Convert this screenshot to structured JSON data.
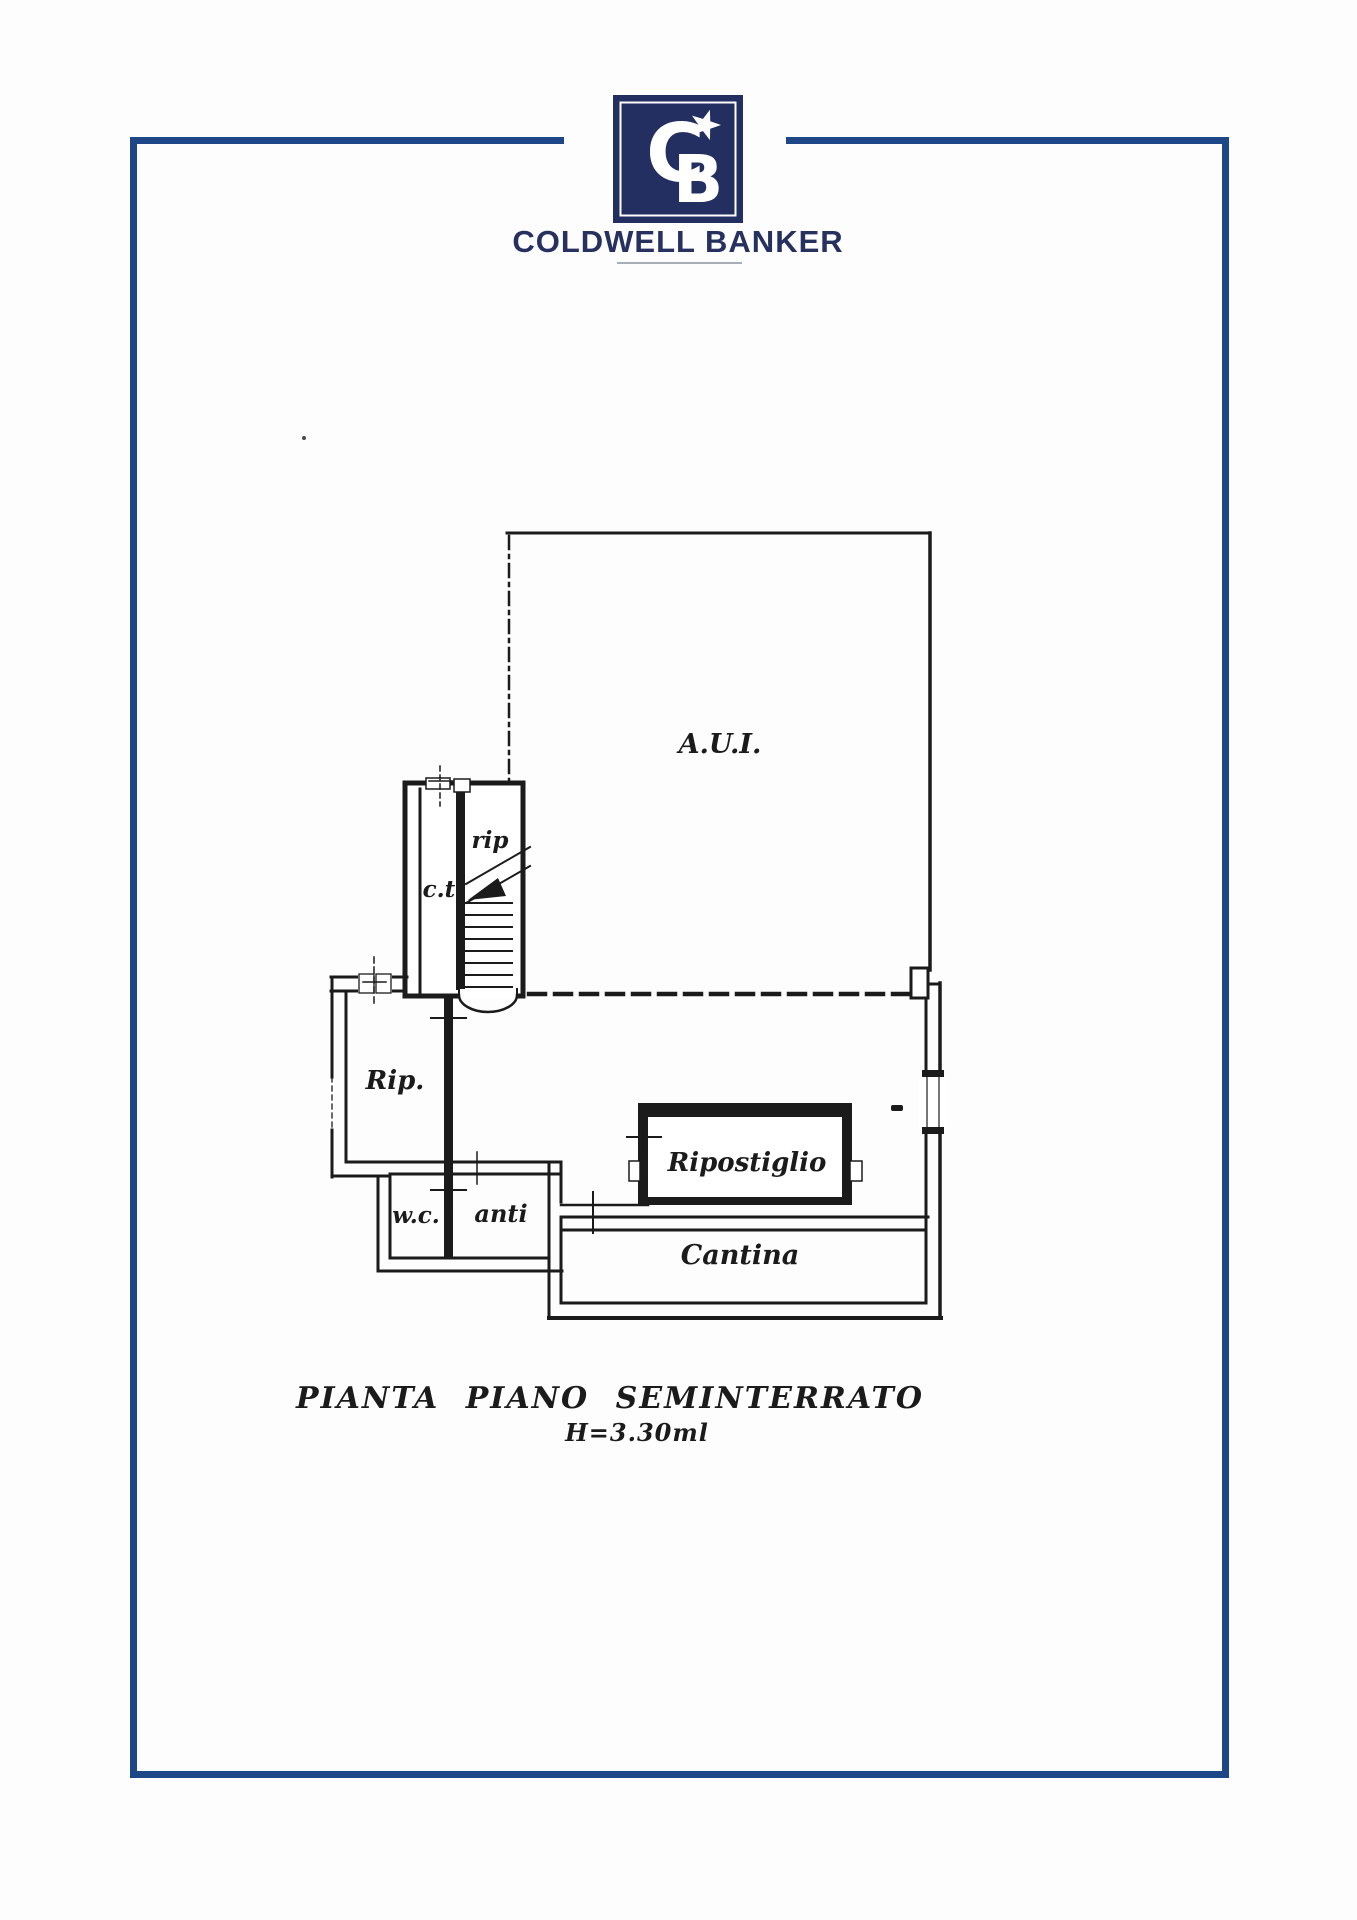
{
  "brand": {
    "wordmark": "COLDWELL BANKER",
    "monogram": {
      "letter_c": "C",
      "letter_b": "B"
    },
    "colors": {
      "logo_navy": "#232f60",
      "wordmark_navy": "#27315f",
      "frame_navy": "#1d4787",
      "underline_gray": "#a8aeb6"
    }
  },
  "floor_plan": {
    "ink": "#1b1b1b",
    "rooms": [
      {
        "id": "aui",
        "label": "A.U.I."
      },
      {
        "id": "rip-stair",
        "label": "rip"
      },
      {
        "id": "ct",
        "label": "c.t."
      },
      {
        "id": "rip",
        "label": "Rip."
      },
      {
        "id": "wc",
        "label": "w.c."
      },
      {
        "id": "anti",
        "label": "anti"
      },
      {
        "id": "ripostiglio",
        "label": "Ripostiglio"
      },
      {
        "id": "cantina",
        "label": "Cantina"
      }
    ]
  },
  "caption": {
    "title": "PIANTA PIANO SEMINTERRATO",
    "height_note": "H=3.30ml"
  }
}
